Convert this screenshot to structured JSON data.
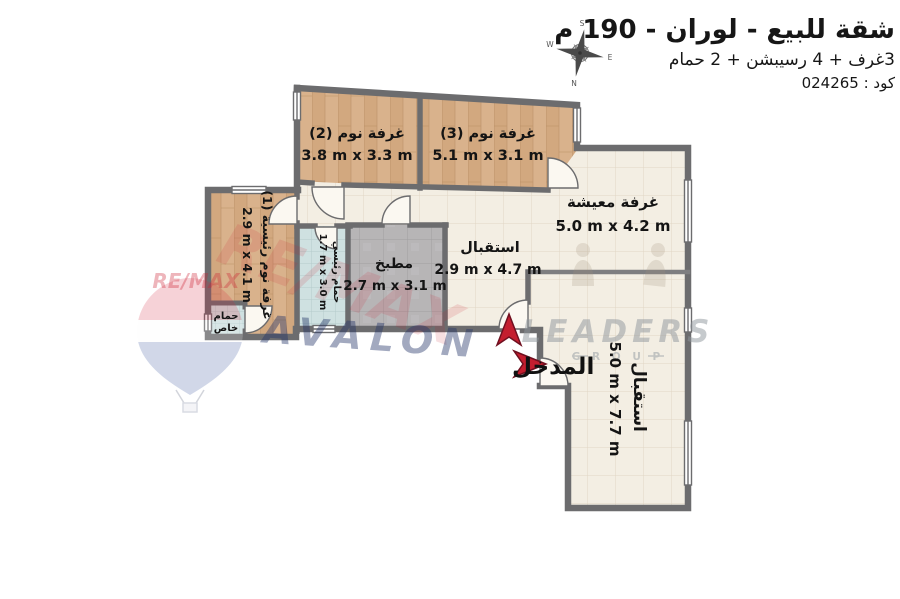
{
  "title": {
    "main": "شقة للبيع - لوران - 190 م",
    "subtitle": "3غرف + 4 رسيبشن + 2 حمام",
    "code": "كود : 024265"
  },
  "compass": {
    "n": "N",
    "s": "S",
    "e": "E",
    "w": "W"
  },
  "rooms": {
    "bedroom2": {
      "name": "غرفة نوم (2)",
      "dims": "3.8 m x 3.3 m"
    },
    "bedroom3": {
      "name": "غرفة نوم (3)",
      "dims": "5.1 m x 3.1 m"
    },
    "living": {
      "name": "غرفة معيشة",
      "dims": "5.0 m x 4.2 m"
    },
    "reception_small": {
      "name": "استقبال",
      "dims": "2.9 m x 4.7 m"
    },
    "reception_large": {
      "name": "استقبال",
      "dims": "5.0 m x 7.7 m"
    },
    "kitchen": {
      "name": "مطبخ",
      "dims": "2.7 m x 3.1 m"
    },
    "master_bedroom": {
      "name": "غرفة نوم رئيسية (1)",
      "dims": "2.9 m x 4.1 m"
    },
    "master_bath": {
      "name": "حمام رئيسي",
      "dims": "1.7 m x 3.0 m"
    },
    "private_bath": {
      "line1": "حمام",
      "line2": "خاص"
    },
    "entrance": {
      "label": "المدخل"
    }
  },
  "watermarks": {
    "remax_small": "RE/MAX",
    "remax_big": "RE/MAX",
    "avalon": "AVALON",
    "leaders": "LEADERS",
    "group": "G R O U P"
  },
  "icons": {
    "compass": "compass-rose",
    "entrance_arrow_up": "red-arrow-up",
    "entrance_arrow_right": "red-arrow-right",
    "balloon": "remax-balloon"
  },
  "colors": {
    "arrow_red": "#c41e2f",
    "wall": "#6c6c6e",
    "wood_floor": "#d9b28c",
    "tile_cream": "#f3eee3",
    "tile_kitchen": "#b7b5b6",
    "tile_bath": "#cfe1e1",
    "remax_red": "#cc2233",
    "avalon_navy": "#243468",
    "leaders_gray": "#8f969c"
  }
}
